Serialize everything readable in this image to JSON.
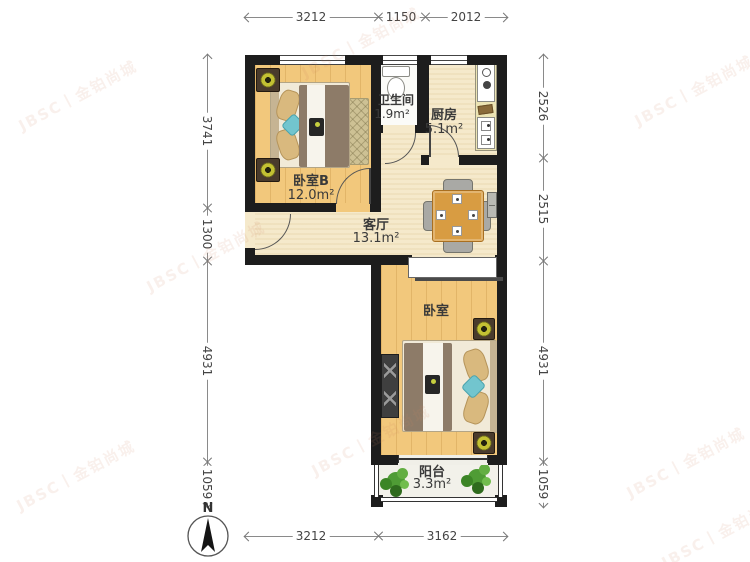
{
  "compass": {
    "label": "N"
  },
  "watermark": {
    "text": "JBSC丨金铂尚城"
  },
  "rooms": {
    "bedroom_b": {
      "name": "卧室B",
      "area": "12.0m²"
    },
    "bathroom": {
      "name": "卫生间",
      "area": "1.9m²"
    },
    "kitchen": {
      "name": "厨房",
      "area": "5.1m²"
    },
    "living": {
      "name": "客厅",
      "area": "13.1m²"
    },
    "bedroom": {
      "name": "卧室"
    },
    "balcony": {
      "name": "阳台",
      "area": "3.3m²"
    }
  },
  "dimensions": {
    "top": [
      "3212",
      "1150",
      "2012"
    ],
    "bottom": [
      "3212",
      "3162"
    ],
    "left": [
      "3741",
      "1300",
      "4931",
      "1059"
    ],
    "right": [
      "2526",
      "2515",
      "4931",
      "1059"
    ]
  },
  "colors": {
    "wall": "#1d1d1d",
    "wood_floor": "#f2c87c",
    "tile_floor": "#f5e9cb",
    "blanket": "#8d7b68",
    "accent_teal": "#72c5ce",
    "table_wood": "#d89c42",
    "plant_green": "#4e9a34"
  }
}
